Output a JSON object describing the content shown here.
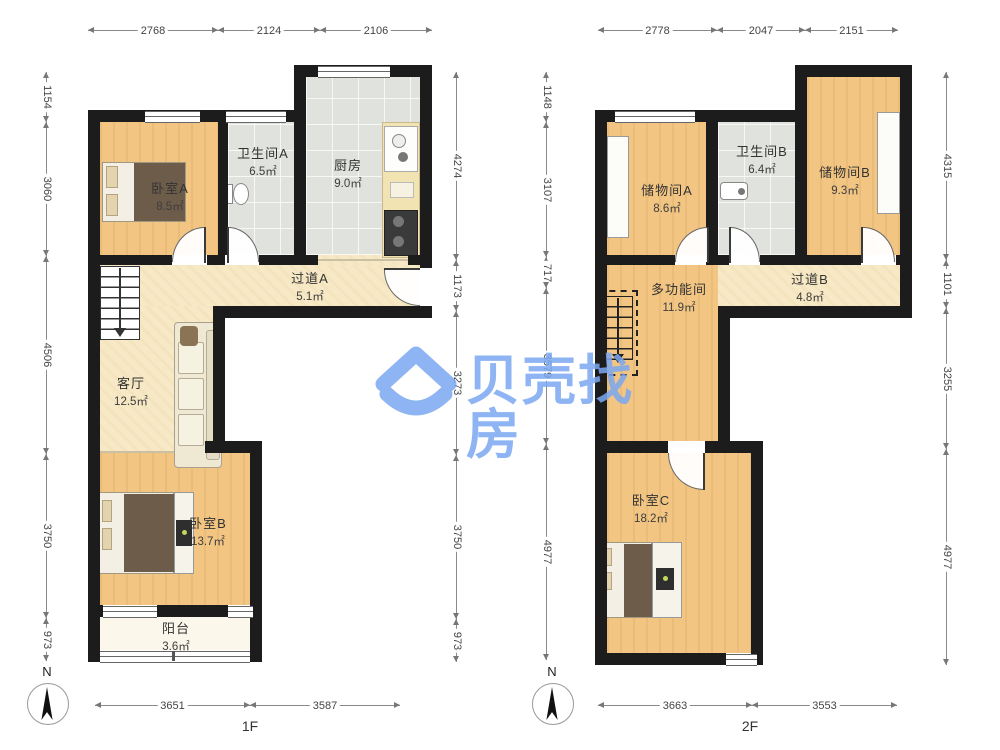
{
  "watermark": {
    "text": "贝壳找房",
    "color": "#7ba8f2"
  },
  "colors": {
    "wall": "#1c1c1c",
    "wood_floor": "#f2c583",
    "tile_floor": "#dfe2dd",
    "hall_floor": "#f7e9c6",
    "balcony_floor": "#fbf7ea",
    "watermark_blue": "#7ba8f2"
  },
  "plans": [
    {
      "floor_label": "1F",
      "compass_label": "N",
      "top_dims": [
        "2768",
        "2124",
        "2106"
      ],
      "left_dims": [
        "1154",
        "3060",
        "4506",
        "3750",
        "973"
      ],
      "right_dims": [
        "4274",
        "1173",
        "3273",
        "3750",
        "973"
      ],
      "bottom_dims": [
        "3651",
        "3587"
      ],
      "rooms": [
        {
          "name": "卧室A",
          "area": "8.5㎡"
        },
        {
          "name": "卫生间A",
          "area": "6.5㎡"
        },
        {
          "name": "厨房",
          "area": "9.0㎡"
        },
        {
          "name": "过道A",
          "area": "5.1㎡"
        },
        {
          "name": "客厅",
          "area": "12.5㎡"
        },
        {
          "name": "卧室B",
          "area": "13.7㎡"
        },
        {
          "name": "阳台",
          "area": "3.6㎡"
        }
      ]
    },
    {
      "floor_label": "2F",
      "compass_label": "N",
      "top_dims": [
        "2778",
        "2047",
        "2151"
      ],
      "left_dims": [
        "1148",
        "3107",
        "717",
        "3579",
        "4977"
      ],
      "right_dims": [
        "4315",
        "1101",
        "3255",
        "4977"
      ],
      "bottom_dims": [
        "3663",
        "3553"
      ],
      "rooms": [
        {
          "name": "储物间A",
          "area": "8.6㎡"
        },
        {
          "name": "卫生间B",
          "area": "6.4㎡"
        },
        {
          "name": "储物间B",
          "area": "9.3㎡"
        },
        {
          "name": "多功能间",
          "area": "11.9㎡"
        },
        {
          "name": "过道B",
          "area": "4.8㎡"
        },
        {
          "name": "卧室C",
          "area": "18.2㎡"
        }
      ]
    }
  ]
}
